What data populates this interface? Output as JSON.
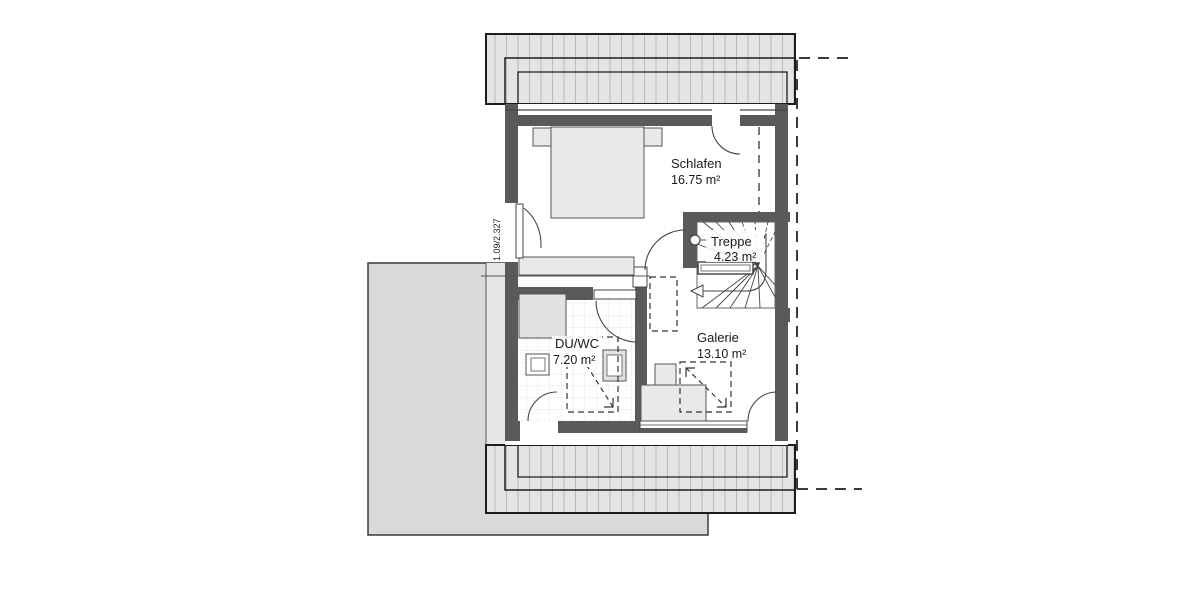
{
  "rooms": [
    {
      "name": "Schlafen",
      "area": "16.75 m²"
    },
    {
      "name": "Treppe",
      "area": "4.23 m²"
    },
    {
      "name": "DU/WC",
      "area": "7.20 m²"
    },
    {
      "name": "Galerie",
      "area": "13.10 m²"
    }
  ],
  "dimension_label": "1.09/2.327",
  "colors": {
    "wall": "#5a5a5a",
    "roof_fill": "#e4e4e4",
    "roof_hatch_line": "#b9b9b9",
    "garage_fill": "#d9d9d9",
    "outline": "#1c1c1c",
    "dashed": "#333333"
  }
}
